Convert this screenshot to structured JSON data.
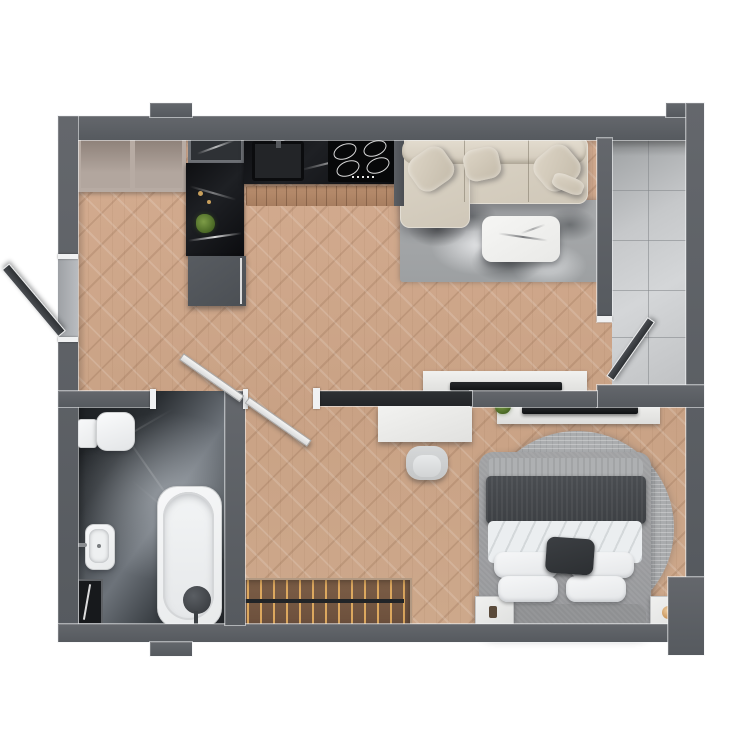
{
  "scene": {
    "description": "photorealistic top-down 3D render of a studio apartment floor plan",
    "view": "top-down",
    "background": "#ffffff"
  },
  "palette": {
    "wall": "#5c5f64",
    "wall_partition_dark": "#26282b",
    "wood_floor": "#cda889",
    "bathroom_marble": "#34383d",
    "balcony_tile": "#c9cbcd",
    "counter_marble_black": "#121418",
    "sofa_beige": "#d8d1c3",
    "rug_living_gray": "#a3a5a8",
    "rug_bedroom_gray": "#aeb0b2",
    "bed_frame_gray": "#9b9c9e",
    "duvet_white": "#e9ecee",
    "blanket_charcoal": "#45484c",
    "fixture_white": "#f4f5f6",
    "accent_gold": "#c08a4d",
    "plant_green": "#5c7d35",
    "doormat_brown": "#6b4f3c"
  },
  "rooms": [
    {
      "name": "kitchen-living-area",
      "floor": "herringbone wood parquet"
    },
    {
      "name": "bedroom-nook",
      "floor": "herringbone wood parquet"
    },
    {
      "name": "hallway-entry",
      "floor": "herringbone wood parquet"
    },
    {
      "name": "bathroom",
      "floor": "dark gray marble"
    },
    {
      "name": "balcony",
      "floor": "light gray stone tile"
    }
  ],
  "furniture": {
    "kitchen": [
      "open-wardrobe-two-bays",
      "decor-niche",
      "black-marble-counter-column",
      "gray-base-cabinet",
      "undermount-sink-with-faucet",
      "cooktop-with-4-burners",
      "wood-slat-runner",
      "potted-plant",
      "gold-decor"
    ],
    "living": [
      "l-shaped-beige-sofa",
      "three-back-cushions",
      "four-throw-pillows",
      "marbled-gray-area-rug",
      "white-marble-coffee-table",
      "white-tv-console",
      "flat-tv"
    ],
    "bedroom": [
      "upholstered-double-bed",
      "gray-foot-throw",
      "charcoal-blanket",
      "white-duvet",
      "four-white-pillows",
      "dark-accent-cushion",
      "round-gray-rug",
      "nightstand-with-decor",
      "nightstand-with-gold-lamp",
      "white-tv-console",
      "flat-tv",
      "potted-plant",
      "wall-desk",
      "desk-chair"
    ],
    "bathroom": [
      "wall-hung-toilet",
      "flush-plate",
      "rectangular-washbasin",
      "wall-faucet",
      "built-in-bathtub",
      "round-floor-mixer",
      "leaning-mirror"
    ],
    "entry": [
      "slatted-doormat-with-brass-pins"
    ]
  },
  "openings": [
    "left-wall-window-sash-open-outward",
    "bathroom-door-open-inward",
    "hallway-door-open",
    "balcony-door-open-inward",
    "entry-recess-bottom-wall"
  ]
}
